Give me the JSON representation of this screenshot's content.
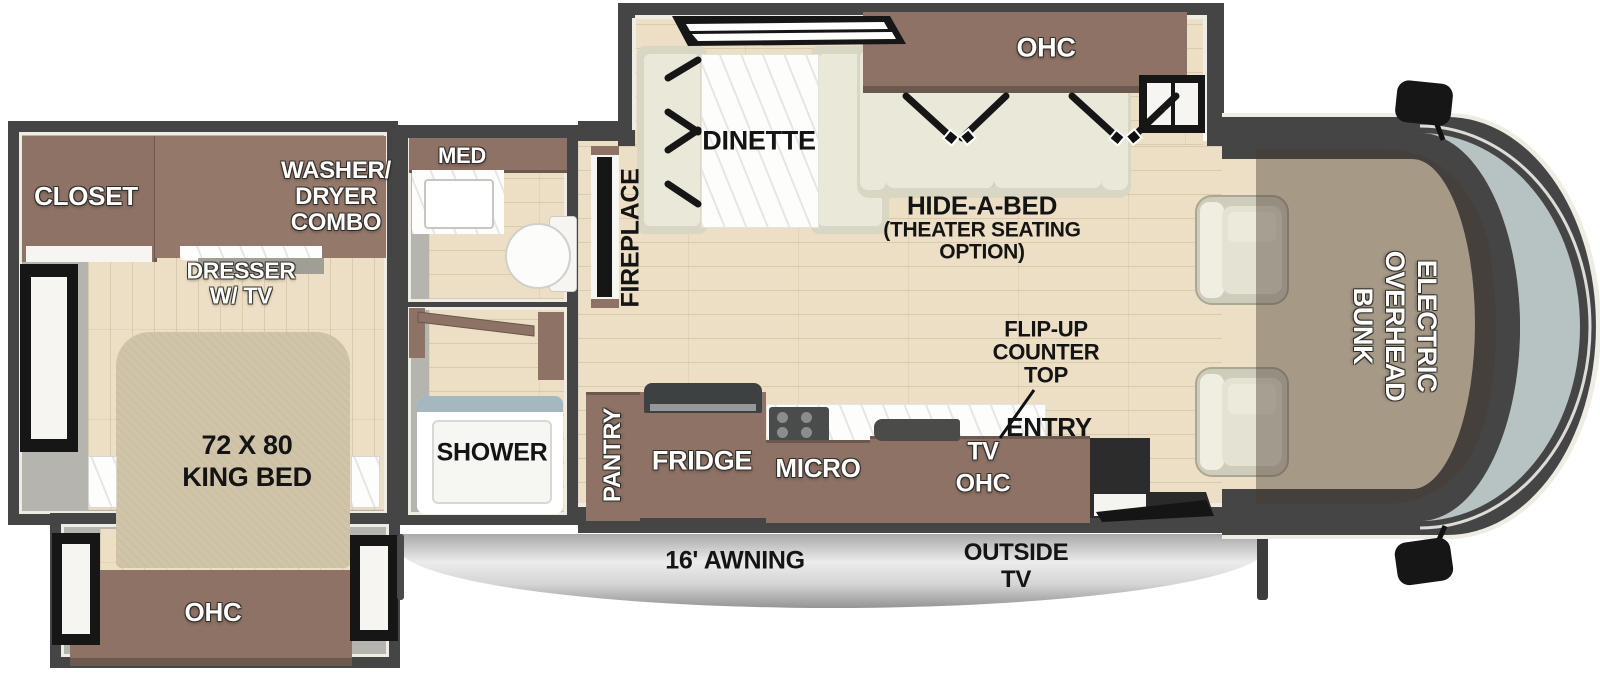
{
  "floorplan": {
    "living": {
      "ohc": "OHC",
      "dinette": "DINETTE",
      "hide_a_bed": {
        "l1": "HIDE-A-BED",
        "l2": "(THEATER SEATING",
        "l3": "OPTION)"
      },
      "fireplace": "FIREPLACE"
    },
    "cab": {
      "bunk": {
        "l1": "ELECTRIC",
        "l2": "OVERHEAD",
        "l3": "BUNK"
      }
    },
    "kitchen": {
      "pantry": "PANTRY",
      "fridge": "FRIDGE",
      "micro": "MICRO",
      "tv": "TV",
      "tv_ohc": "OHC",
      "flip_up": {
        "l1": "FLIP-UP",
        "l2": "COUNTER",
        "l3": "TOP"
      },
      "entry": "ENTRY"
    },
    "bathroom": {
      "med": "MED",
      "shower": "SHOWER"
    },
    "bedroom": {
      "closet": "CLOSET",
      "washer_dryer": {
        "l1": "WASHER/",
        "l2": "DRYER",
        "l3": "COMBO"
      },
      "dresser": {
        "l1": "DRESSER",
        "l2": "W/ TV"
      },
      "king_bed": {
        "l1": "72 X 80",
        "l2": "KING BED"
      },
      "ohc": "OHC"
    },
    "exterior": {
      "awning": "16' AWNING",
      "outside_tv": {
        "l1": "OUTSIDE",
        "l2": "TV"
      }
    }
  },
  "colors": {
    "wall": "#454545",
    "trim": "#efece4",
    "interior": "#b5b4ae",
    "floor": "#ecdfc5",
    "cabinet": "#8d7265",
    "cabinet_dark": "#6b584e",
    "seat": "#eae8d9",
    "seat_base": "#d9d6c4",
    "bed": "#cdc1a5",
    "glass": "#b7c3c2",
    "awning": "#d9d9d9",
    "black": "#161616",
    "white": "#f6f5f1",
    "marble": "#fdfdfb",
    "overlay": "rgba(70,58,48,0.42)"
  }
}
